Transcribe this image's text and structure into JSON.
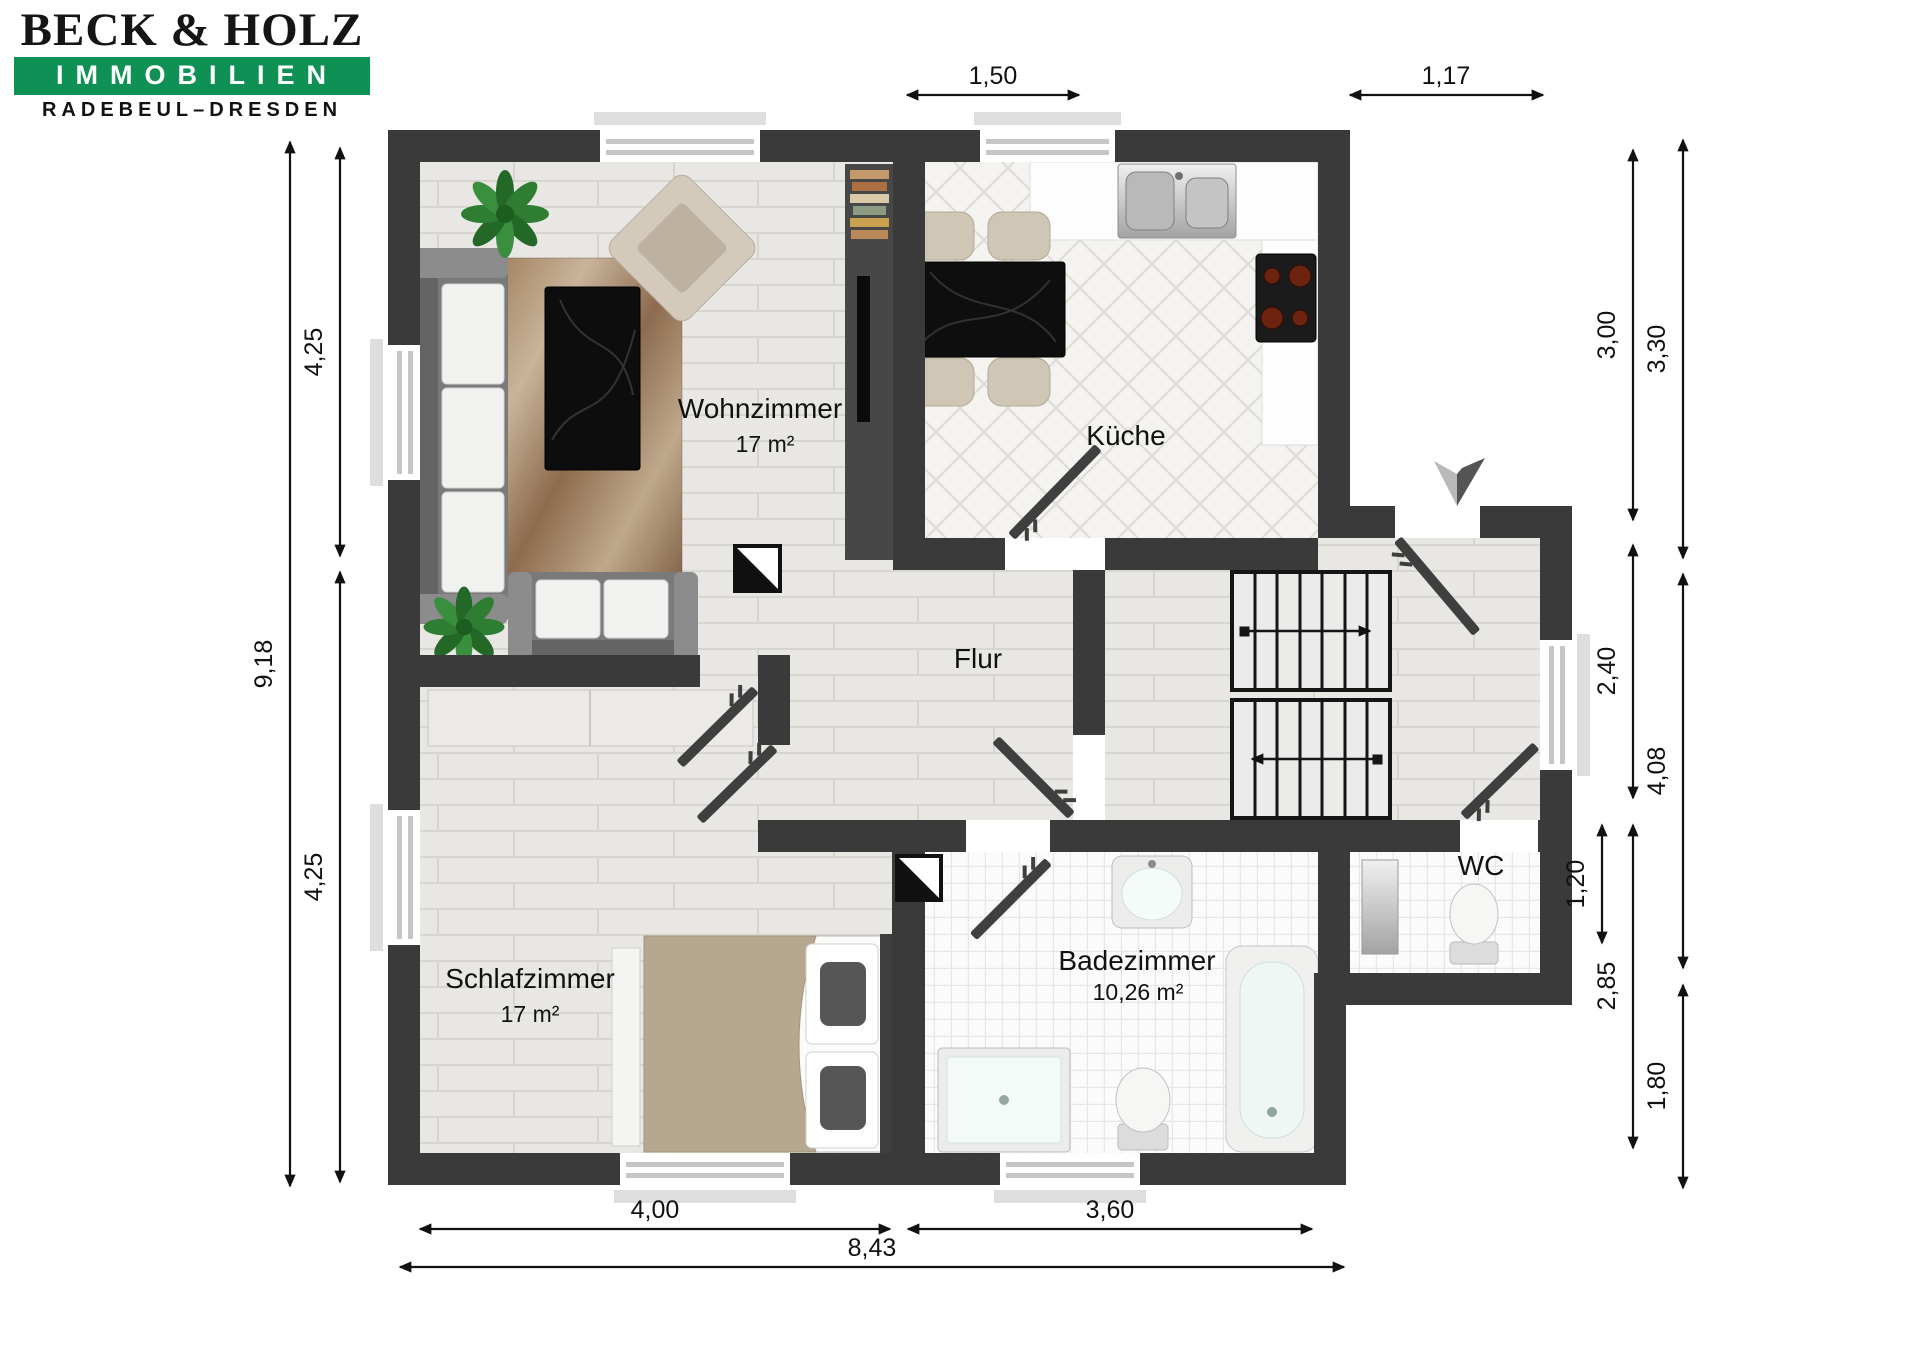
{
  "logo": {
    "name": "BECK & HOLZ",
    "division": "IMMOBILIEN",
    "city": "RADEBEUL–DRESDEN"
  },
  "rooms": {
    "wohnzimmer": {
      "name": "Wohnzimmer",
      "area": "17 m²"
    },
    "kueche": {
      "name": "Küche"
    },
    "flur": {
      "name": "Flur"
    },
    "schlafzimmer": {
      "name": "Schlafzimmer",
      "area": "17 m²"
    },
    "badezimmer": {
      "name": "Badezimmer",
      "area": "10,26 m²"
    },
    "wc": {
      "name": "WC"
    }
  },
  "dimensions": {
    "top": [
      "1,50",
      "1,17"
    ],
    "left": [
      "9,18",
      "4,25",
      "4,25"
    ],
    "right": [
      "3,00",
      "3,30",
      "2,40",
      "4,08",
      "1,20",
      "2,85",
      "1,80"
    ],
    "bottom": [
      "4,00",
      "3,60",
      "8,43"
    ]
  },
  "colors": {
    "brand_green": "#0f9156",
    "wall": "#3a3a3a",
    "floor_wood": "#e8e7e4",
    "floor_tile": "#f4f3f0"
  }
}
